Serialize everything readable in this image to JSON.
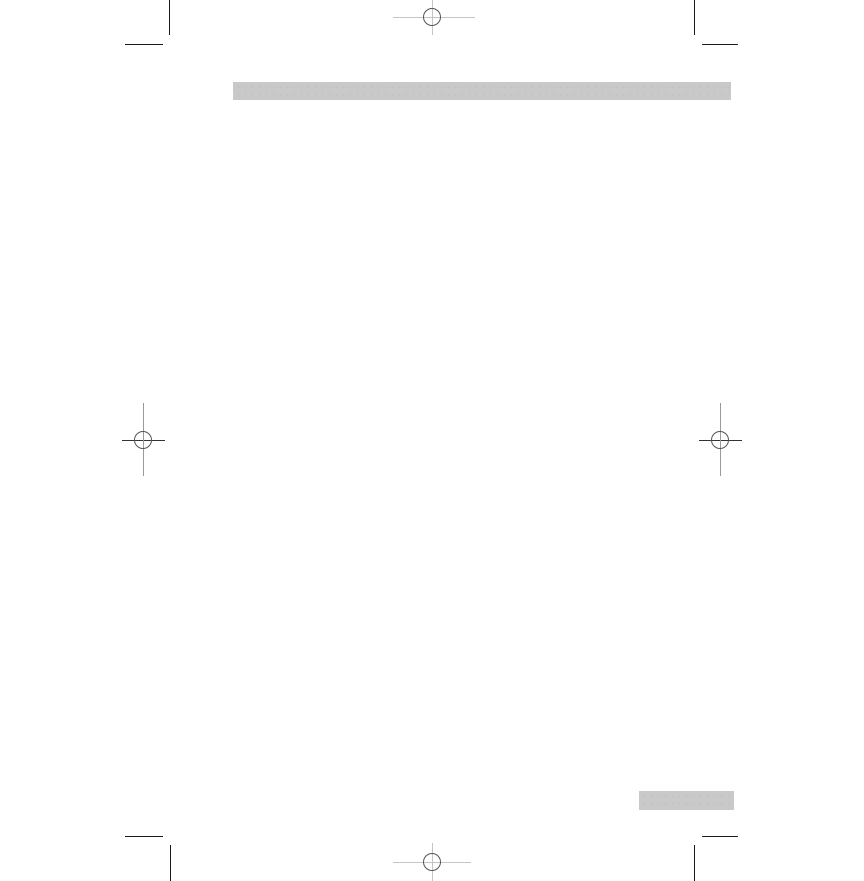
{
  "page": {
    "width": 864,
    "height": 881,
    "background": "#ffffff",
    "description_visible_text": ""
  },
  "colors": {
    "bar_fill": "#c9c9c9",
    "bar_dot": "#c1c1c1",
    "crop_mark": "#1a1a1a",
    "reg_line_light": "#c4c4c4",
    "reg_line_mid": "#9a9a9a",
    "reg_line_dark": "#333333",
    "reg_circle": "#555555"
  },
  "graphics": {
    "header_bar": {
      "x": 233,
      "y": 82,
      "width": 498,
      "height": 18
    },
    "footer_tab": {
      "x": 639,
      "y": 791,
      "width": 95,
      "height": 19
    },
    "registration_marks": [
      {
        "id": "registration-mark-top-center",
        "cx": 432,
        "cy": 17,
        "r": 9,
        "circle_color": "reg_circle",
        "h_line": {
          "x1": 393,
          "x2": 475,
          "y": 17,
          "color": "reg_line_light"
        },
        "v_line": {
          "y1": 0,
          "y2": 35,
          "x": 432,
          "color": "reg_line_light"
        }
      },
      {
        "id": "registration-mark-left-middle",
        "cx": 143,
        "cy": 440,
        "r": 9,
        "circle_color": "reg_circle",
        "h_line": {
          "x1": 122,
          "x2": 165,
          "y": 440,
          "color": "reg_line_dark"
        },
        "v_line": {
          "y1": 403,
          "y2": 476,
          "x": 143,
          "color": "reg_line_mid"
        }
      },
      {
        "id": "registration-mark-right-middle",
        "cx": 720,
        "cy": 440,
        "r": 9,
        "circle_color": "reg_circle",
        "h_line": {
          "x1": 699,
          "x2": 742,
          "y": 440,
          "color": "reg_line_dark"
        },
        "v_line": {
          "y1": 403,
          "y2": 476,
          "x": 720,
          "color": "reg_line_mid"
        }
      },
      {
        "id": "registration-mark-bottom-center",
        "cx": 432,
        "cy": 862,
        "r": 9,
        "circle_color": "reg_circle",
        "h_line": {
          "x1": 393,
          "x2": 471,
          "y": 862,
          "color": "reg_line_light"
        },
        "v_line": {
          "y1": 843,
          "y2": 881,
          "x": 432,
          "color": "reg_line_light"
        }
      }
    ],
    "crop_marks": [
      {
        "id": "crop-mark-top-left",
        "v_line": {
          "x": 169,
          "y1": 0,
          "y2": 35
        },
        "h_line": {
          "y": 44,
          "x1": 125,
          "x2": 163
        }
      },
      {
        "id": "crop-mark-top-right",
        "v_line": {
          "x": 694,
          "y1": 0,
          "y2": 35
        },
        "h_line": {
          "y": 44,
          "x1": 702,
          "x2": 738
        }
      },
      {
        "id": "crop-mark-bottom-left",
        "v_line": {
          "x": 170,
          "y1": 845,
          "y2": 881
        },
        "h_line": {
          "y": 836,
          "x1": 125,
          "x2": 163
        }
      },
      {
        "id": "crop-mark-bottom-right",
        "v_line": {
          "x": 694,
          "y1": 845,
          "y2": 881
        },
        "h_line": {
          "y": 836,
          "x1": 702,
          "x2": 738
        }
      }
    ]
  }
}
